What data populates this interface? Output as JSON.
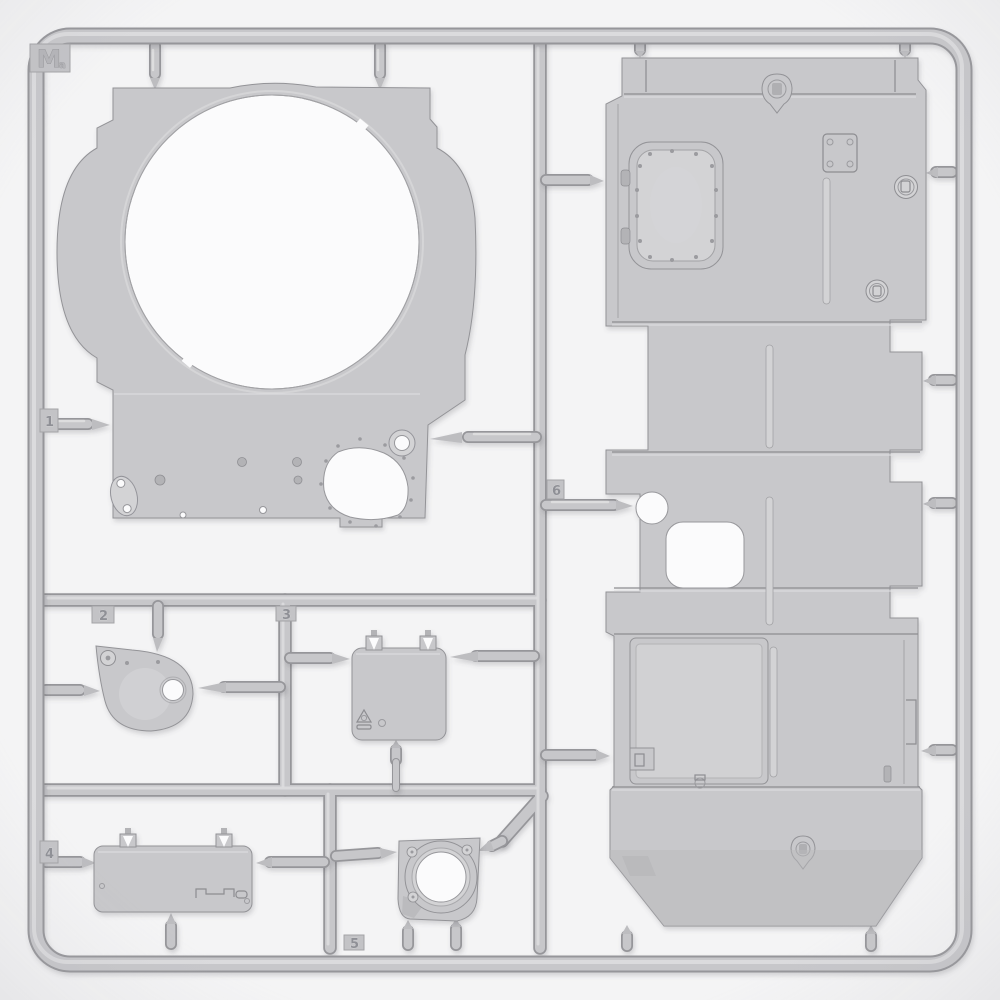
{
  "photo": {
    "subject": "injection-molded plastic model kit sprue with tank hull and turret parts",
    "plastic_color_name": "light gray"
  },
  "sprue": {
    "letter": "M",
    "letter_suffix": "a",
    "part_tabs": [
      {
        "number": "1"
      },
      {
        "number": "2"
      },
      {
        "number": "3"
      },
      {
        "number": "4"
      },
      {
        "number": "5"
      },
      {
        "number": "6"
      }
    ],
    "parts": [
      {
        "id": "1",
        "name": "turret-roof-with-large-ring-opening"
      },
      {
        "id": "2",
        "name": "round-hatch-with-hinge"
      },
      {
        "id": "3",
        "name": "square-hatch-panel"
      },
      {
        "id": "4",
        "name": "rectangular-deck-panel"
      },
      {
        "id": "5",
        "name": "ventilator-housing"
      },
      {
        "id": "6",
        "name": "large-engine-deck-plate"
      }
    ]
  },
  "colors": {
    "background": "#f4f4f5",
    "plastic_base": "#c8c8cb",
    "plastic_shadow": "#96969a",
    "plastic_highlight": "#dddddf",
    "cutout": "#fbfbfc"
  }
}
